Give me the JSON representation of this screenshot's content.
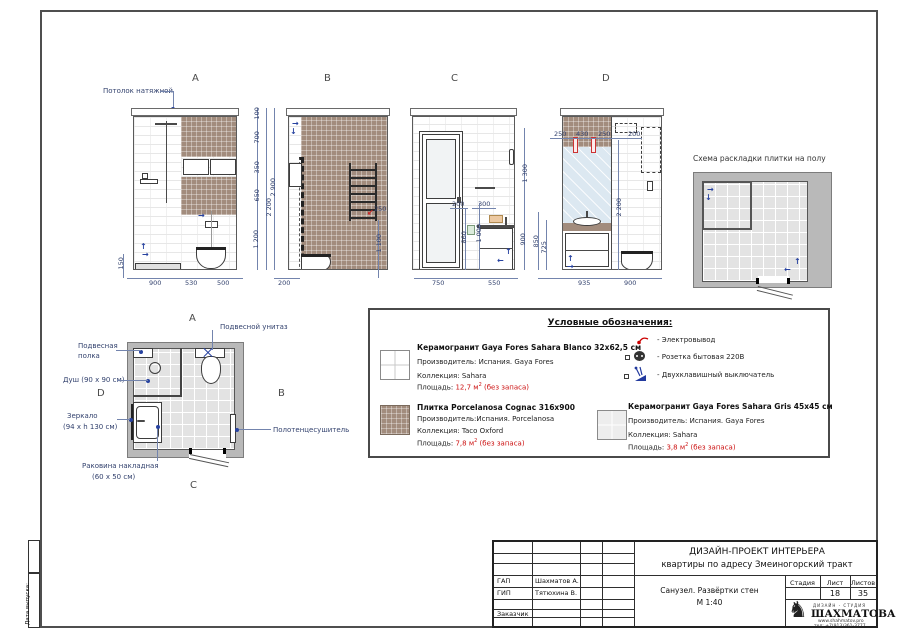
{
  "labels": {
    "a": "A",
    "b": "B",
    "c": "C",
    "d": "D"
  },
  "ceiling_note": "Потолок натяжной",
  "dims": {
    "a": [
      "100",
      "700",
      "350",
      "650",
      "1 200",
      "2 200",
      "150",
      "900",
      "530",
      "500"
    ],
    "b": [
      "2 900",
      "250",
      "1 100",
      "200"
    ],
    "c": [
      "200",
      "300",
      "860",
      "1 000",
      "1 300",
      "900",
      "750",
      "550"
    ],
    "d": [
      "250",
      "430",
      "250",
      "200",
      "2 200",
      "850",
      "725",
      "935",
      "900"
    ]
  },
  "tile_scheme": {
    "title": "Схема раскладки плитки на полу"
  },
  "plan": {
    "notes": {
      "toilet": "Подвесной унитаз",
      "shelf_l1": "Подвесная",
      "shelf_l2": "полка",
      "shower": "Душ (90 x 90 см)",
      "mirror_l1": "Зеркало",
      "mirror_l2": "(94 x h 130 см)",
      "sink_l1": "Раковина накладная",
      "sink_l2": "(60 x 50 см)",
      "towel": "Полотенцесушитель"
    }
  },
  "legend": {
    "title": "Условные обозначения:",
    "sup2": "2",
    "tiles": [
      {
        "name": "Керамогранит Gaya Fores Sahara Blanco 32x62,5 см",
        "manufacturer": "Производитель: Испания. Gaya Fores",
        "collection": "Коллекция: Sahara",
        "area_label": "Площадь:",
        "area_value": "12,7 м",
        "area_note": " (без запаса)"
      },
      {
        "name": "Плитка Porcelanosa Cognac 316x900",
        "manufacturer": "Производитель:Испания. Porcelanosa",
        "collection": "Коллекция: Taco Oxford",
        "area_label": "Площадь:",
        "area_value": "7,8 м",
        "area_note": " (без запаса)"
      },
      {
        "name": "Керамогранит Gaya Fores Sahara Gris 45x45 см",
        "manufacturer": "Производитель: Испания. Gaya Fores",
        "collection": "Коллекция: Sahara",
        "area_label": "Площадь:",
        "area_value": "3,8 м",
        "area_note": " (без запаса)"
      }
    ],
    "symbols": [
      "- Электровывод",
      "- Розетка бытовая 220В",
      "- Двухклавишный выключатель"
    ]
  },
  "titleblock": {
    "project_l1": "ДИЗАЙН-ПРОЕКТ ИНТЕРЬЕРА",
    "project_l2": "квартиры по адресу Змеиногорский тракт",
    "gap_label": "ГАП",
    "gap_name": "Шахматов А.",
    "gip_label": "ГИП",
    "gip_name": "Тятюхина В.",
    "customer_label": "Заказчик",
    "sheet_title_l1": "Санузел. Развёртки стен",
    "sheet_title_l2": "М 1:40",
    "stage_label": "Стадия",
    "sheet_label": "Лист",
    "sheets_label": "Листов",
    "sheet_no": "18",
    "sheets_total": "35",
    "logo_small": "ДИЗАЙН - СТУДИЯ",
    "logo_name": "ШАХМАТОВА",
    "logo_site": "www.shahmatov.pro",
    "logo_phone": "тел: +7(913)361-3777",
    "date_label": "Дата выпуска:"
  },
  "colors": {
    "dimension_blue": "#33426e",
    "warning_red": "#cc1111",
    "tile_brown": "#a28c7d",
    "tile_white": "#ffffff",
    "tile_gray": "#ededed",
    "wall_gray": "#b9b9b9",
    "mirror_blue": "#dce8f1"
  }
}
